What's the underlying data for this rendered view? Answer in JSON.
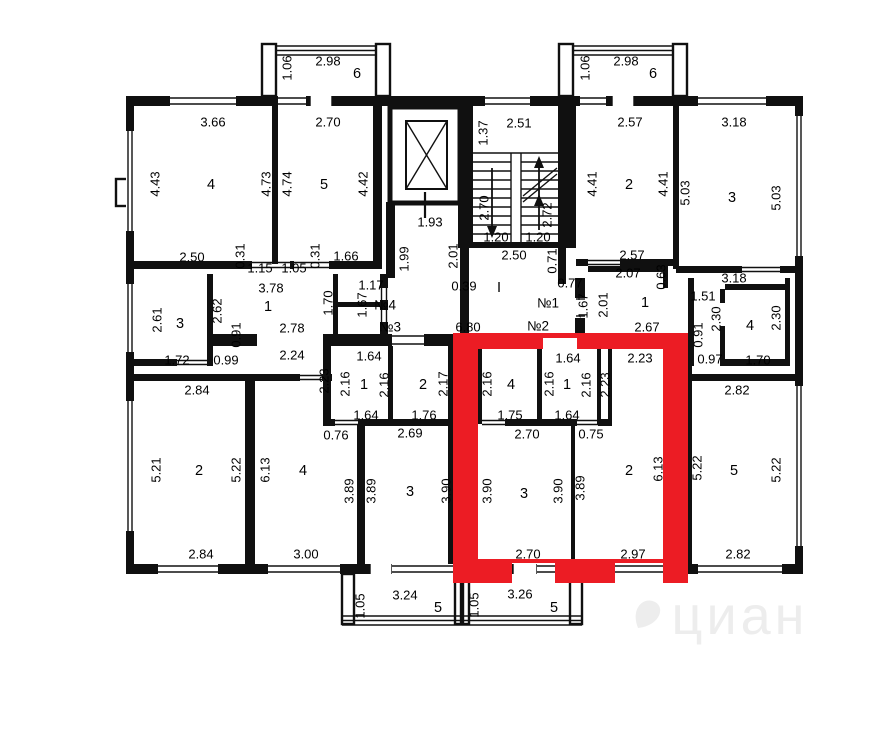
{
  "colors": {
    "wall": "#101010",
    "highlight": "#ec1c24",
    "watermark_color": "#ededed"
  },
  "watermark": {
    "text": "циан"
  },
  "labels": [
    {
      "t": "1.06",
      "x": 248,
      "y": 52,
      "r": -90
    },
    {
      "t": "2.98",
      "x": 288,
      "y": 46
    },
    {
      "t": "6",
      "x": 317,
      "y": 58,
      "k": "n"
    },
    {
      "t": "1.06",
      "x": 546,
      "y": 52,
      "r": -90
    },
    {
      "t": "2.98",
      "x": 586,
      "y": 46
    },
    {
      "t": "6",
      "x": 613,
      "y": 58,
      "k": "n"
    },
    {
      "t": "3.66",
      "x": 173,
      "y": 107
    },
    {
      "t": "2.70",
      "x": 288,
      "y": 107
    },
    {
      "t": "2.57",
      "x": 590,
      "y": 107
    },
    {
      "t": "3.18",
      "x": 694,
      "y": 107
    },
    {
      "t": "4.43",
      "x": 116,
      "y": 168,
      "r": -90
    },
    {
      "t": "4",
      "x": 171,
      "y": 169,
      "k": "n"
    },
    {
      "t": "4.73",
      "x": 227,
      "y": 168,
      "r": -90
    },
    {
      "t": "4.74",
      "x": 248,
      "y": 168,
      "r": -90
    },
    {
      "t": "5",
      "x": 284,
      "y": 169,
      "k": "n"
    },
    {
      "t": "4.42",
      "x": 324,
      "y": 168,
      "r": -90
    },
    {
      "t": "4.41",
      "x": 553,
      "y": 168,
      "r": -90
    },
    {
      "t": "2",
      "x": 589,
      "y": 169,
      "k": "n"
    },
    {
      "t": "4.41",
      "x": 624,
      "y": 168,
      "r": -90
    },
    {
      "t": "5.03",
      "x": 646,
      "y": 177,
      "r": -90
    },
    {
      "t": "3",
      "x": 692,
      "y": 182,
      "k": "n"
    },
    {
      "t": "5.03",
      "x": 737,
      "y": 182,
      "r": -90
    },
    {
      "t": "1.99",
      "x": 365,
      "y": 243,
      "r": -90
    },
    {
      "t": "1.93",
      "x": 390,
      "y": 207
    },
    {
      "t": "2.01",
      "x": 414,
      "y": 240,
      "r": -90
    },
    {
      "t": "1.37",
      "x": 444,
      "y": 117,
      "r": -90
    },
    {
      "t": "2.51",
      "x": 479,
      "y": 108
    },
    {
      "t": "2.70",
      "x": 445,
      "y": 192,
      "r": -90
    },
    {
      "t": "2.72",
      "x": 508,
      "y": 199,
      "r": -90
    },
    {
      "t": "1.20",
      "x": 456,
      "y": 222
    },
    {
      "t": "1.20",
      "x": 498,
      "y": 222
    },
    {
      "t": "2.50",
      "x": 474,
      "y": 240
    },
    {
      "t": "0.71",
      "x": 513,
      "y": 245,
      "r": -90
    },
    {
      "t": "2.50",
      "x": 152,
      "y": 242
    },
    {
      "t": "0.31",
      "x": 201,
      "y": 240,
      "r": -90
    },
    {
      "t": "1.15",
      "x": 220,
      "y": 253
    },
    {
      "t": "1.05",
      "x": 254,
      "y": 253
    },
    {
      "t": "0.31",
      "x": 276,
      "y": 240,
      "r": -90
    },
    {
      "t": "1.66",
      "x": 306,
      "y": 241
    },
    {
      "t": "2.57",
      "x": 592,
      "y": 240
    },
    {
      "t": "3.18",
      "x": 694,
      "y": 263
    },
    {
      "t": "0.39",
      "x": 424,
      "y": 271
    },
    {
      "t": "I",
      "x": 459,
      "y": 272,
      "k": "n"
    },
    {
      "t": "0.77",
      "x": 530,
      "y": 268
    },
    {
      "t": "№1",
      "x": 508,
      "y": 288,
      "k": "u"
    },
    {
      "t": "№4",
      "x": 345,
      "y": 290,
      "k": "u"
    },
    {
      "t": "№3",
      "x": 350,
      "y": 312,
      "k": "u"
    },
    {
      "t": "№2",
      "x": 498,
      "y": 311,
      "k": "u"
    },
    {
      "t": "3.78",
      "x": 231,
      "y": 273
    },
    {
      "t": "1",
      "x": 228,
      "y": 291,
      "k": "n"
    },
    {
      "t": "2.78",
      "x": 252,
      "y": 313
    },
    {
      "t": "1.70",
      "x": 289,
      "y": 287,
      "r": -90
    },
    {
      "t": "1.67",
      "x": 323,
      "y": 289,
      "r": -90
    },
    {
      "t": "1.17",
      "x": 331,
      "y": 270
    },
    {
      "t": "2.61",
      "x": 118,
      "y": 304,
      "r": -90
    },
    {
      "t": "3",
      "x": 140,
      "y": 308,
      "k": "n"
    },
    {
      "t": "1.72",
      "x": 137,
      "y": 345
    },
    {
      "t": "2.62",
      "x": 178,
      "y": 295,
      "r": -90
    },
    {
      "t": "0.91",
      "x": 197,
      "y": 319,
      "r": -90
    },
    {
      "t": "0.99",
      "x": 186,
      "y": 345
    },
    {
      "t": "6.80",
      "x": 428,
      "y": 312
    },
    {
      "t": "2.07",
      "x": 588,
      "y": 258
    },
    {
      "t": "0.63",
      "x": 622,
      "y": 261,
      "r": -90
    },
    {
      "t": "1.67",
      "x": 544,
      "y": 290,
      "r": -90
    },
    {
      "t": "2.01",
      "x": 564,
      "y": 289,
      "r": -90
    },
    {
      "t": "1",
      "x": 605,
      "y": 287,
      "k": "n"
    },
    {
      "t": "2.67",
      "x": 607,
      "y": 312
    },
    {
      "t": "1.51",
      "x": 663,
      "y": 281
    },
    {
      "t": "0.91",
      "x": 659,
      "y": 319,
      "r": -90
    },
    {
      "t": "2.30",
      "x": 677,
      "y": 303,
      "r": -90
    },
    {
      "t": "4",
      "x": 710,
      "y": 310,
      "k": "n"
    },
    {
      "t": "2.30",
      "x": 737,
      "y": 302,
      "r": -90
    },
    {
      "t": "0.97",
      "x": 670,
      "y": 344
    },
    {
      "t": "1.70",
      "x": 718,
      "y": 345
    },
    {
      "t": "2.24",
      "x": 252,
      "y": 340
    },
    {
      "t": "1.64",
      "x": 329,
      "y": 341
    },
    {
      "t": "2.23",
      "x": 285,
      "y": 365,
      "r": -90
    },
    {
      "t": "2.16",
      "x": 306,
      "y": 368,
      "r": -90
    },
    {
      "t": "1",
      "x": 324,
      "y": 369,
      "k": "n"
    },
    {
      "t": "2.16",
      "x": 345,
      "y": 369,
      "r": -90
    },
    {
      "t": "1.64",
      "x": 326,
      "y": 400
    },
    {
      "t": "2",
      "x": 383,
      "y": 369,
      "k": "n"
    },
    {
      "t": "2.17",
      "x": 404,
      "y": 368,
      "r": -90
    },
    {
      "t": "1.76",
      "x": 384,
      "y": 400
    },
    {
      "t": "2.16",
      "x": 448,
      "y": 368,
      "r": -90
    },
    {
      "t": "4",
      "x": 471,
      "y": 369,
      "k": "n"
    },
    {
      "t": "1.75",
      "x": 470,
      "y": 400
    },
    {
      "t": "1.64",
      "x": 528,
      "y": 343
    },
    {
      "t": "2.16",
      "x": 510,
      "y": 368,
      "r": -90
    },
    {
      "t": "1",
      "x": 527,
      "y": 369,
      "k": "n"
    },
    {
      "t": "2.16",
      "x": 547,
      "y": 369,
      "r": -90
    },
    {
      "t": "1.64",
      "x": 527,
      "y": 400
    },
    {
      "t": "2.23",
      "x": 566,
      "y": 369,
      "r": -90
    },
    {
      "t": "2.23",
      "x": 600,
      "y": 343
    },
    {
      "t": "0.76",
      "x": 296,
      "y": 420
    },
    {
      "t": "2.69",
      "x": 370,
      "y": 418
    },
    {
      "t": "2.70",
      "x": 487,
      "y": 419
    },
    {
      "t": "0.75",
      "x": 551,
      "y": 419
    },
    {
      "t": "2.84",
      "x": 157,
      "y": 375
    },
    {
      "t": "5.21",
      "x": 117,
      "y": 454,
      "r": -90
    },
    {
      "t": "2",
      "x": 159,
      "y": 455,
      "k": "n"
    },
    {
      "t": "5.22",
      "x": 197,
      "y": 454,
      "r": -90
    },
    {
      "t": "2.84",
      "x": 161,
      "y": 539
    },
    {
      "t": "6.13",
      "x": 226,
      "y": 454,
      "r": -90
    },
    {
      "t": "4",
      "x": 263,
      "y": 455,
      "k": "n"
    },
    {
      "t": "3.00",
      "x": 266,
      "y": 539
    },
    {
      "t": "3.89",
      "x": 310,
      "y": 475,
      "r": -90
    },
    {
      "t": "3.89",
      "x": 332,
      "y": 475,
      "r": -90
    },
    {
      "t": "3",
      "x": 370,
      "y": 476,
      "k": "n"
    },
    {
      "t": "3.90",
      "x": 407,
      "y": 475,
      "r": -90
    },
    {
      "t": "3.90",
      "x": 448,
      "y": 475,
      "r": -90
    },
    {
      "t": "3",
      "x": 484,
      "y": 478,
      "k": "n"
    },
    {
      "t": "3.90",
      "x": 519,
      "y": 475,
      "r": -90
    },
    {
      "t": "2.70",
      "x": 488,
      "y": 539
    },
    {
      "t": "3.89",
      "x": 541,
      "y": 472,
      "r": -90
    },
    {
      "t": "2",
      "x": 589,
      "y": 455,
      "k": "n"
    },
    {
      "t": "6.13",
      "x": 619,
      "y": 453,
      "r": -90
    },
    {
      "t": "2.97",
      "x": 593,
      "y": 539
    },
    {
      "t": "5.22",
      "x": 658,
      "y": 452,
      "r": -90
    },
    {
      "t": "5",
      "x": 694,
      "y": 455,
      "k": "n"
    },
    {
      "t": "5.22",
      "x": 737,
      "y": 454,
      "r": -90
    },
    {
      "t": "2.82",
      "x": 697,
      "y": 375
    },
    {
      "t": "2.82",
      "x": 698,
      "y": 539
    },
    {
      "t": "1.05",
      "x": 321,
      "y": 590,
      "r": -90
    },
    {
      "t": "3.24",
      "x": 365,
      "y": 580
    },
    {
      "t": "5",
      "x": 398,
      "y": 592,
      "k": "n"
    },
    {
      "t": "1.05",
      "x": 435,
      "y": 589,
      "r": -90
    },
    {
      "t": "3.26",
      "x": 480,
      "y": 579
    },
    {
      "t": "5",
      "x": 514,
      "y": 592,
      "k": "n"
    }
  ]
}
